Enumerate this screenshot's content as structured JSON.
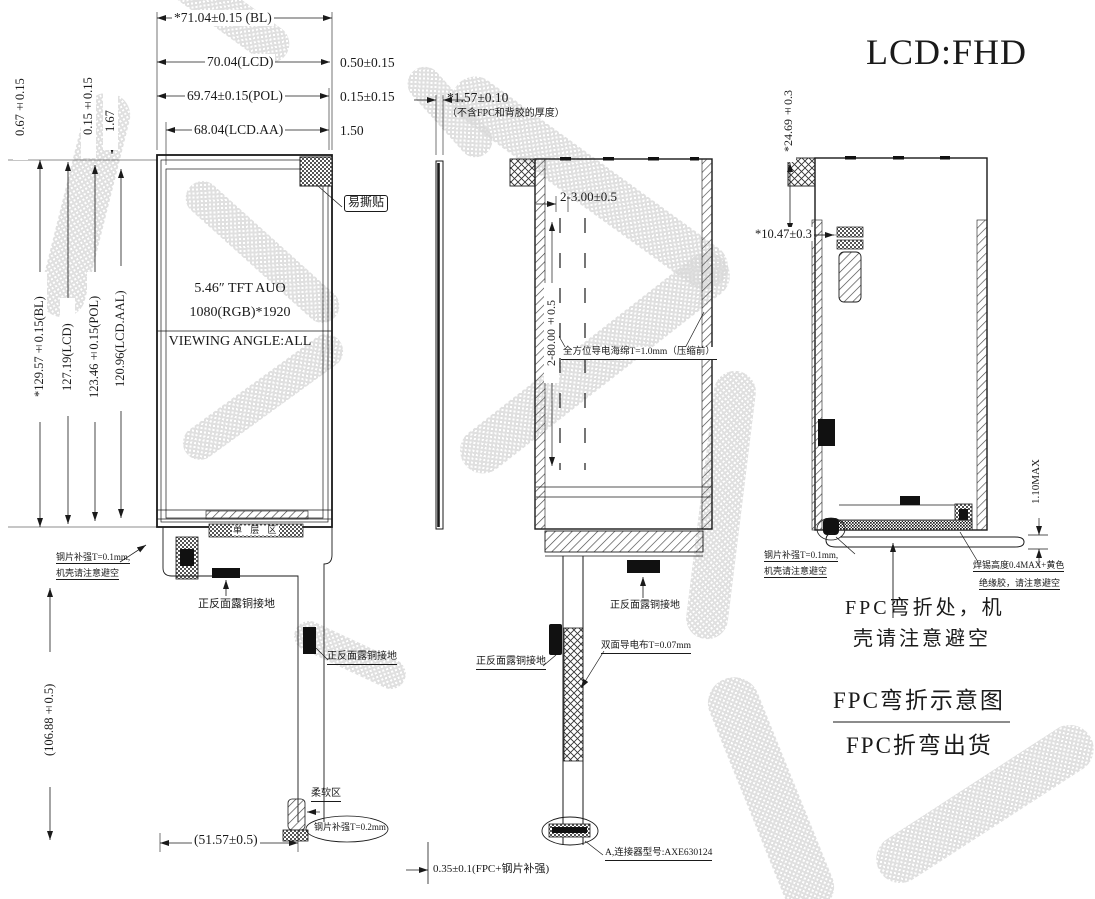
{
  "title": "LCD:FHD",
  "colors": {
    "line": "#1a1a1a",
    "watermark": "#d9d9d9"
  },
  "front_view": {
    "dim_bl_w": "*71.04±0.15 (BL)",
    "dim_lcd_w": "70.04(LCD)",
    "dim_pol_w": "69.74±0.15(POL)",
    "dim_aa_w": "68.04(LCD.AA)",
    "off_lcd": "0.50±0.15",
    "off_pol": "0.15±0.15",
    "off_aa": "1.50",
    "left_off_1": "0.67±0.15",
    "left_off_2": "0.15±0.15",
    "left_off_3": "1.67",
    "dim_bl_h": "*129.57±0.15(BL)",
    "dim_lcd_h": "127.19(LCD)",
    "dim_pol_h": "123.46±0.15(POL)",
    "dim_aa_h": "120.96(LCD.AAL)",
    "panel_line1": "5.46″ TFT AUO",
    "panel_line2": "1080(RGB)*1920",
    "panel_line3": "VIEWING ANGLE:ALL",
    "peel_label": "易撕贴",
    "single_layer": "单 层 区",
    "steel_note_a": "钢片补强T=0.1mm,",
    "steel_note_b": "机壳请注意避空",
    "copper_top": "正反面露铜接地",
    "copper_tail": "正反面露铜接地",
    "soft_area": "柔软区",
    "steel_02": "钢片补强T=0.2mm",
    "fpc_w": "(51.57±0.5)",
    "fpc_l": "(106.88±0.5)"
  },
  "side_view": {
    "thickness": "*1.57±0.10",
    "thickness_note": "（不含FPC和背胶的厚度）"
  },
  "back_view": {
    "sponge_w": "2-3.00±0.5",
    "sponge_l": "2-80.00±0.5",
    "sponge_label": "全方位导电海绵T=1.0mm（压缩前）",
    "copper_right": "正反面露铜接地",
    "copper_left": "正反面露铜接地",
    "tape_label": "双面导电布T=0.07mm",
    "connector_label": "A,连接器型号:AXE630124",
    "fpc_stack": "0.35±0.1(FPC+钢片补强)"
  },
  "bend_view": {
    "dim_height": "*24.69±0.3",
    "dim_fold": "*10.47±0.3",
    "dim_max": "1.10MAX",
    "steel_a": "钢片补强T=0.1mm,",
    "steel_b": "机壳请注意避空",
    "solder_a": "焊锡高度0.4MAX+黄色",
    "solder_b": "绝缘胶，请注意避空",
    "bend_a": "FPC弯折处，机",
    "bend_b": "壳请注意避空",
    "caption_title": "FPC弯折示意图",
    "caption_sub": "FPC折弯出货"
  }
}
